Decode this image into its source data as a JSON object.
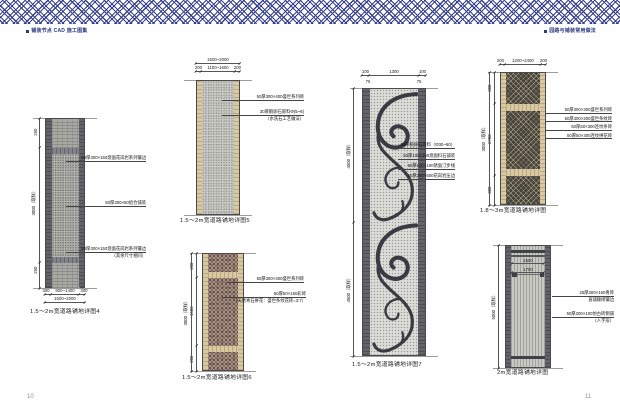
{
  "header": {
    "left_title": "铺装节点 CAD 施工图集",
    "right_title": "园路与铺装常用做法"
  },
  "page_numbers": {
    "left": "10",
    "right": "11"
  },
  "colors": {
    "accent_navy": "#35418c",
    "tan_brick": "#d9c9a3",
    "dark_stone": "#63636a",
    "mosaic_red": "#7b4b43"
  },
  "drawings": {
    "d1": {
      "caption": "1.5～2m宽道路铺地详图4",
      "dims": {
        "left_seg_top": "250",
        "left_total": "3000（取样）",
        "left_seg_bottom": "250",
        "bottom_tier1": [
          "300",
          "900~1400",
          "300"
        ],
        "bottom_tier2": "1500~2000"
      },
      "annotations": [
        {
          "lines": [
            "50厚300×150烧面花岗岩系列镶边"
          ]
        },
        {
          "lines": [
            "50厚300×50组合铺装"
          ]
        },
        {
          "lines": [
            "50厚300×150烧面花岗岩系列镶边",
            "（其余尺寸相同）"
          ]
        }
      ]
    },
    "d2": {
      "caption": "1.5～2m宽道路铺地详图5",
      "dims": {
        "top_total": "1500~2000",
        "top_tier2": [
          "200",
          "1100~1600",
          "200"
        ]
      },
      "annotations": [
        {
          "lines": [
            "50厚300×400盛世系列砖"
          ]
        },
        {
          "lines": [
            "30厚鹅卵石嵌料Φ(5~8)",
            "（水洗石工艺做法）"
          ]
        }
      ]
    },
    "d3": {
      "caption": "1.5～2m宽道路铺地详图6",
      "dims": {
        "left_segs": [
          "200",
          "1500",
          "200"
        ],
        "left_total": "3000（取样）"
      },
      "annotations": [
        {
          "lines": [
            "50厚300×300盛世系列砖"
          ]
        },
        {
          "lines": [
            "50厚50×150彩砖",
            "（天然青石拼花：盛世条纹花砖=3:7）"
          ]
        }
      ]
    },
    "d4": {
      "caption": "1.5～2m宽道路铺地详图7",
      "dims": {
        "top": [
          "100",
          "1300",
          "100"
        ],
        "top_sub": [
          "75",
          "75"
        ],
        "left_upper": "4500（取样）",
        "left_lower": "4500（取样）"
      },
      "annotations": [
        {
          "lines": [
            "30厚鹅卵石嵌料（Φ30~50）"
          ]
        },
        {
          "lines": [
            "50厚100×100烧面料石铺装"
          ]
        },
        {
          "lines": [
            "50厚100×100锈面汀步线"
          ]
        },
        {
          "lines": [
            "50厚250×500花岗岩压边"
          ]
        }
      ]
    },
    "d5": {
      "caption": "1.8～3m宽道路铺地详图",
      "dims": {
        "top": [
          "200",
          "1200~2400",
          "200"
        ],
        "left_segs": [
          "300",
          "2700",
          "300"
        ],
        "left_total": "3000（取样）"
      },
      "annotations": [
        {
          "lines": [
            "50厚300×300盛世系列砖"
          ]
        },
        {
          "lines": [
            "50厚300×200盛世条纹砖"
          ]
        },
        {
          "lines": [
            "50厚50×300连纹条砖"
          ]
        },
        {
          "lines": [
            "50厚50×300连纹拼花砖"
          ]
        }
      ]
    },
    "d6": {
      "caption": "2m宽道路铺地详图",
      "dims": {
        "inner": [
          "1500",
          "1700"
        ],
        "left_total": "5000（取样）"
      },
      "annotations": [
        {
          "lines": [
            "25厚300×150青砖",
            "直铺顺砌镶边"
          ]
        },
        {
          "lines": [
            "50厚200×100仿古砖侧铺",
            "（人字形）"
          ]
        }
      ]
    }
  }
}
